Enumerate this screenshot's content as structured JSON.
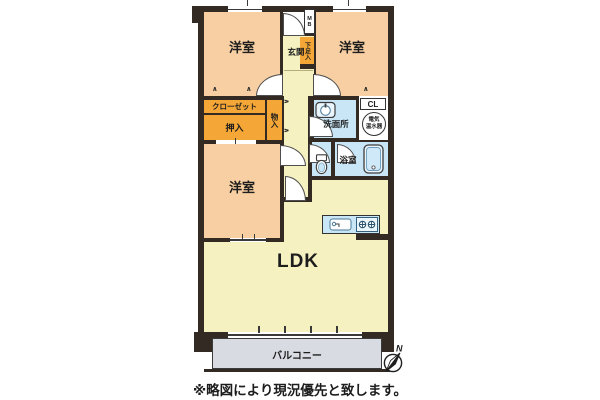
{
  "colors": {
    "wall": "#332a24",
    "bedroom": "#f7cfa2",
    "hall": "#f5f1c1",
    "storage": "#f4a636",
    "wet": "#c8e6f5",
    "fixture": "#eaf5fc",
    "balcony": "#d8dbe2"
  },
  "labels": {
    "bedroom1": "洋室",
    "bedroom2": "洋室",
    "bedroom3": "洋室",
    "entrance": "玄関",
    "shoe_cabinet": "下足入",
    "meter_box": "MB",
    "closet": "クローゼット",
    "futon_closet": "押入",
    "storage": "物入",
    "washroom": "洗面所",
    "closet_cl": "CL",
    "water_heater_line1": "電気",
    "water_heater_line2": "温水器",
    "bathroom": "浴室",
    "ldk": "LDK",
    "balcony": "バルコニー"
  },
  "compass": {
    "north": "N"
  },
  "note": "※略図により現況優先と致します。"
}
